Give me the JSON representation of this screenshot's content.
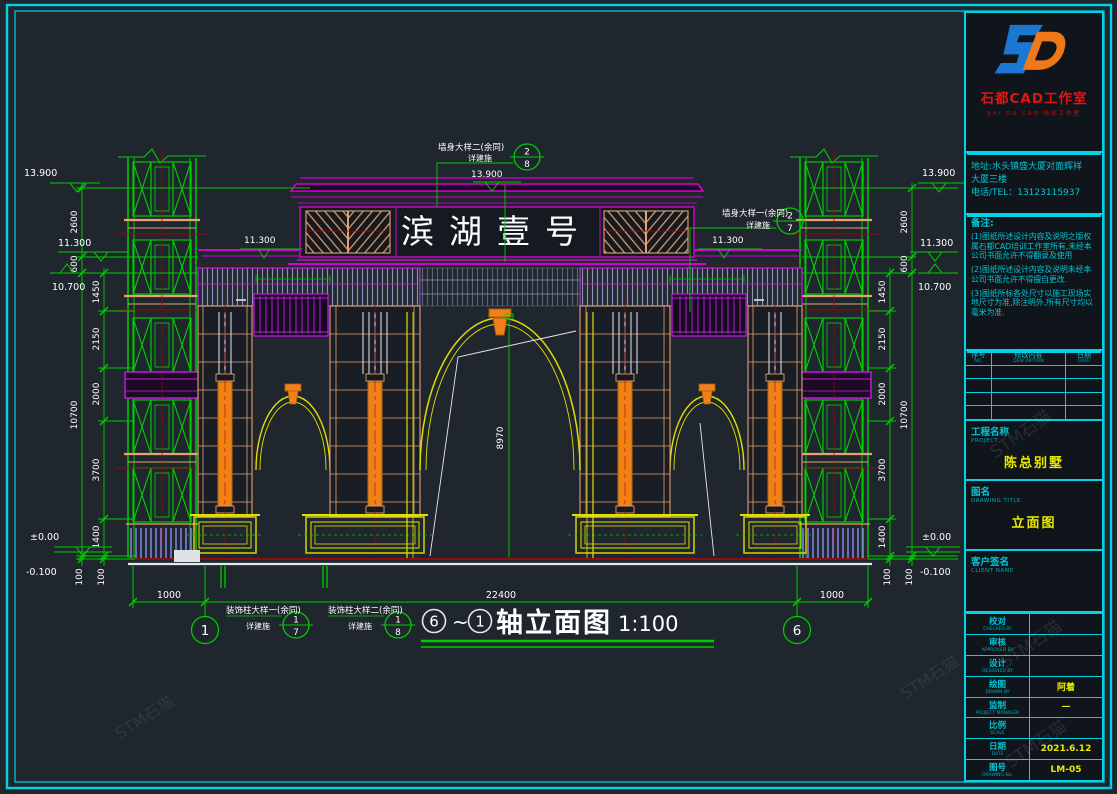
{
  "sheet": {
    "bg": "#20262e",
    "frame_color": "#00d4e4"
  },
  "drawing": {
    "sign": "滨湖壹号",
    "axis_title": {
      "from": "6",
      "tilde": "~",
      "to": "1",
      "text": "轴立面图",
      "scale": "1:100"
    },
    "grid_bubbles": {
      "left": "1",
      "right": "6"
    },
    "elevations": {
      "top": "13.900",
      "upper": "11.300",
      "cornice": "10.700",
      "zero": "±0.00",
      "minus": "-0.100"
    },
    "dims": {
      "v2600": "2600",
      "v600": "600",
      "v10700": "10700",
      "v100": "100",
      "v1450": "1450",
      "v2150": "2150",
      "v2000": "2000",
      "v3700": "3700",
      "v1400": "1400",
      "arch_height": "8970",
      "side": "1000",
      "span": "22400"
    },
    "callouts": {
      "wall2": {
        "label": "墙身大样二(余同)",
        "ref": "详建施",
        "num": "2",
        "sheet": "8"
      },
      "wall1": {
        "label": "墙身大样一(余同)",
        "ref": "详建施",
        "num": "2",
        "sheet": "7"
      },
      "col1": {
        "label": "装饰柱大样一(余同)",
        "ref": "详建施",
        "num": "1",
        "sheet": "7"
      },
      "col2": {
        "label": "装饰柱大样二(余同)",
        "ref": "详建施",
        "num": "1",
        "sheet": "8"
      }
    }
  },
  "titleblock": {
    "studio_name": "石都CAD工作室",
    "studio_sub": "SHI DU CAD 培训工作室",
    "address_line1": "地址:水头镇盛大厦对面辉祥",
    "address_line2": "大厦三楼",
    "phone": "电话/TEL：13123115937",
    "notes_title": "备注:",
    "note1": "(1)图纸所述设计内容及说明之版权属石都CAD培训工作室所有,未经本公司书面允许不得翻录及使用",
    "note2": "(2)图纸所述设计内容及说明未经本公司书面允许不得擅自更改.",
    "note3": "(3)图纸所标各处尺寸以施工现场实地尺寸为准,除注明外,所有尺寸均以毫米为准.",
    "rev_headers": [
      {
        "zh": "序号",
        "en": "NO."
      },
      {
        "zh": "修改内容",
        "en": "DESCRIPTION"
      },
      {
        "zh": "日期",
        "en": "DATE"
      }
    ],
    "project": {
      "zh": "工程名称",
      "en": "PROJECT",
      "value": "陈总别墅"
    },
    "drawing_title": {
      "zh": "图名",
      "en": "DRAWING TITLE",
      "value": "立面图"
    },
    "client": {
      "zh": "客户签名",
      "en": "CLIENT NAME",
      "value": ""
    },
    "fields": [
      {
        "zh": "校对",
        "en": "CHECKED BY",
        "value": ""
      },
      {
        "zh": "审核",
        "en": "APPROVED BY",
        "value": ""
      },
      {
        "zh": "设计",
        "en": "DESIGNED BY",
        "value": ""
      },
      {
        "zh": "绘图",
        "en": "DRAWN BY",
        "value": "阿着"
      },
      {
        "zh": "监制",
        "en": "PROJECT MANAGER",
        "value": "—"
      },
      {
        "zh": "比例",
        "en": "SCALE",
        "value": ""
      },
      {
        "zh": "日期",
        "en": "DATE",
        "value": "2021.6.12"
      },
      {
        "zh": "图号",
        "en": "DRAWING No.",
        "value": "LM-05"
      }
    ],
    "watermark": "STM石猫"
  }
}
